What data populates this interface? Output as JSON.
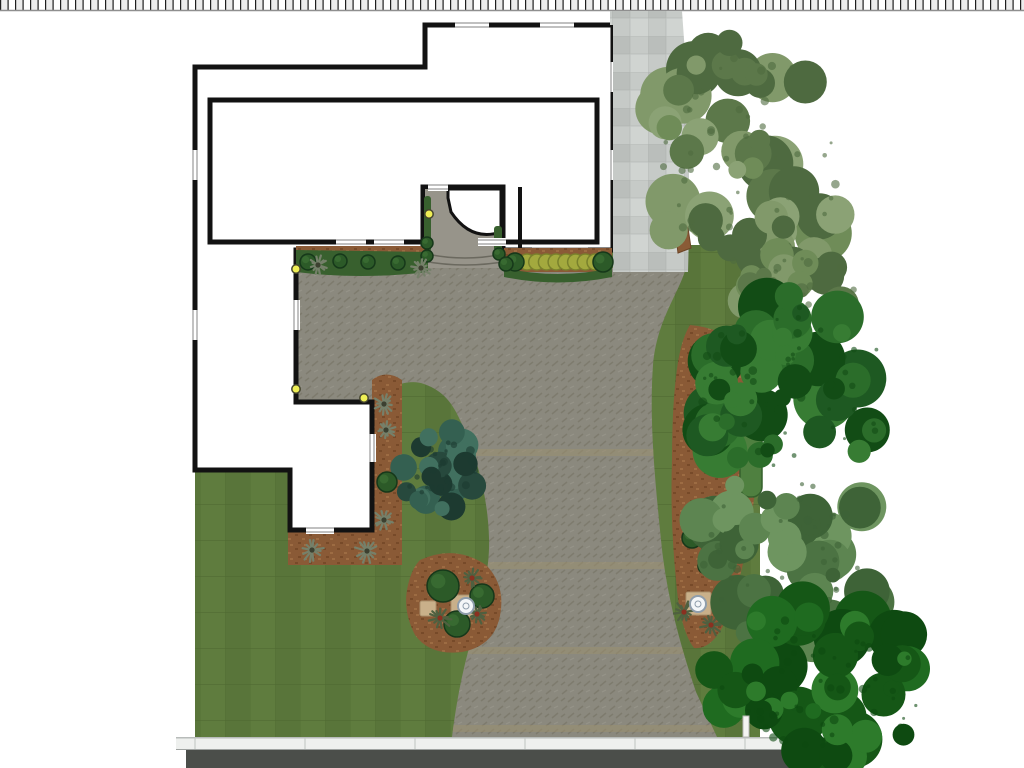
{
  "scene": {
    "type": "landscape-site-plan",
    "canvas": {
      "width": 1024,
      "height": 768
    },
    "plan_elements": [
      "scale-strip",
      "house-footprint",
      "front-entry-walkway",
      "paver-driveway",
      "paver-patio",
      "stone-side-path",
      "lawn",
      "foundation-planting-bed",
      "boxwood-hedge-row",
      "side-mulch-bed",
      "island-planting-bed",
      "east-mulch-bed",
      "juniper-shrub",
      "street",
      "sidewalk",
      "mailbox-post",
      "landscape-lights",
      "birdbaths",
      "street-trees"
    ],
    "counts": {
      "landscape_lights": 4,
      "birdbaths": 2,
      "hedge_shrubs": 8,
      "trees": 5
    },
    "colors": {
      "wall": "#121212",
      "house_fill": "#ffffff",
      "lawn": "#59753a",
      "lawn_stripe": "#5f7c3e",
      "lawn_line": "#4e6831",
      "paver": "#8b897e",
      "paver_motif": "#797768",
      "paver_band": "#9a9070",
      "walkway": "#97948a",
      "stone": "#c6cac7",
      "stone_dark": "#b7bcb9",
      "stone_light": "#d0d4d1",
      "mulch": "#8a5a36",
      "mulch_dark": "#774a29",
      "mulch_light": "#9d6c43",
      "bed_green": "#38602e",
      "hedge": "#a3a93e",
      "hedge_stroke": "#79812c",
      "bright_hedge": "#4f8040",
      "shrub": "#2c5a28",
      "shrub_stroke": "#16381a",
      "street": "#4b4e4a",
      "sidewalk": "#eef0ee",
      "sidewalk_line": "#c6cac8",
      "light": "#efef55",
      "light_ring": "#45452f",
      "birdbath": "#f4f6f8",
      "birdbath_ring": "#8f9dab",
      "trunk": "#8a5b36",
      "yucca_gray": "#75806a",
      "yucca_red": "#8a3020",
      "post": "#f4f4f2",
      "ruler_tick": "#1e1e1e",
      "ruler_cell": "#ececec",
      "ruler_edge": "#8f8f8f"
    },
    "ruler": {
      "tick_spacing": 7.5,
      "height": 10
    },
    "paver_bands": [
      449,
      562,
      647,
      725
    ],
    "sidewalk_joints": [
      195,
      305,
      415,
      525,
      635,
      745
    ],
    "lights": [
      {
        "x": 296,
        "y": 269
      },
      {
        "x": 429,
        "y": 214
      },
      {
        "x": 296,
        "y": 389
      },
      {
        "x": 364,
        "y": 398
      }
    ],
    "birdbaths": [
      {
        "x": 466,
        "y": 606
      },
      {
        "x": 698,
        "y": 604
      }
    ],
    "pads": [
      {
        "x": 420,
        "y": 601,
        "w": 16,
        "h": 15
      },
      {
        "x": 451,
        "y": 595,
        "w": 27,
        "h": 22
      },
      {
        "x": 686,
        "y": 592,
        "w": 25,
        "h": 23
      }
    ],
    "hedge_row": {
      "x_start": 527,
      "x_end": 595,
      "count": 8,
      "y": 262,
      "r": 8
    },
    "shrubs": [
      {
        "x": 515,
        "y": 262,
        "r": 9
      },
      {
        "x": 603,
        "y": 262,
        "r": 10
      },
      {
        "x": 308,
        "y": 262,
        "r": 8
      },
      {
        "x": 340,
        "y": 261,
        "r": 7
      },
      {
        "x": 368,
        "y": 262,
        "r": 7
      },
      {
        "x": 398,
        "y": 263,
        "r": 7
      },
      {
        "x": 427,
        "y": 243,
        "r": 6
      },
      {
        "x": 427,
        "y": 256,
        "r": 6
      },
      {
        "x": 499,
        "y": 254,
        "r": 6
      },
      {
        "x": 506,
        "y": 264,
        "r": 7
      },
      {
        "x": 387,
        "y": 482,
        "r": 10
      },
      {
        "x": 443,
        "y": 586,
        "r": 16
      },
      {
        "x": 482,
        "y": 596,
        "r": 12
      },
      {
        "x": 457,
        "y": 624,
        "r": 13
      },
      {
        "x": 692,
        "y": 538,
        "r": 10
      },
      {
        "x": 706,
        "y": 566,
        "r": 8
      }
    ],
    "spiky_plants": [
      {
        "x": 318,
        "y": 265,
        "r": 9,
        "red": false
      },
      {
        "x": 421,
        "y": 268,
        "r": 9,
        "red": false
      },
      {
        "x": 384,
        "y": 404,
        "r": 10,
        "red": false
      },
      {
        "x": 386,
        "y": 430,
        "r": 9,
        "red": false
      },
      {
        "x": 384,
        "y": 520,
        "r": 10,
        "red": false
      },
      {
        "x": 312,
        "y": 550,
        "r": 11,
        "red": false
      },
      {
        "x": 367,
        "y": 551,
        "r": 11,
        "red": false
      },
      {
        "x": 730,
        "y": 462,
        "r": 10,
        "red": false
      },
      {
        "x": 440,
        "y": 618,
        "r": 11,
        "red": true
      },
      {
        "x": 477,
        "y": 614,
        "r": 10,
        "red": true
      },
      {
        "x": 472,
        "y": 578,
        "r": 9,
        "red": true
      },
      {
        "x": 684,
        "y": 612,
        "r": 10,
        "red": true
      },
      {
        "x": 711,
        "y": 625,
        "r": 10,
        "red": true
      }
    ],
    "windows": [
      {
        "x": 455,
        "y": 21,
        "w": 34,
        "h": 8,
        "o": "h"
      },
      {
        "x": 540,
        "y": 21,
        "w": 34,
        "h": 8,
        "o": "h"
      },
      {
        "x": 609,
        "y": 62,
        "w": 8,
        "h": 30,
        "o": "v"
      },
      {
        "x": 609,
        "y": 150,
        "w": 8,
        "h": 30,
        "o": "v"
      },
      {
        "x": 336,
        "y": 238,
        "w": 30,
        "h": 8,
        "o": "h"
      },
      {
        "x": 374,
        "y": 238,
        "w": 30,
        "h": 8,
        "o": "h"
      },
      {
        "x": 478,
        "y": 238,
        "w": 28,
        "h": 8,
        "o": "h"
      },
      {
        "x": 532,
        "y": 246,
        "w": 56,
        "h": 8,
        "o": "h"
      },
      {
        "x": 191,
        "y": 150,
        "w": 8,
        "h": 30,
        "o": "v"
      },
      {
        "x": 191,
        "y": 310,
        "w": 8,
        "h": 30,
        "o": "v"
      },
      {
        "x": 292,
        "y": 300,
        "w": 8,
        "h": 30,
        "o": "v"
      },
      {
        "x": 368,
        "y": 434,
        "w": 8,
        "h": 28,
        "o": "v"
      },
      {
        "x": 306,
        "y": 526,
        "w": 28,
        "h": 8,
        "o": "h"
      },
      {
        "x": 428,
        "y": 183,
        "w": 20,
        "h": 8,
        "o": "h"
      }
    ],
    "trees": [
      {
        "name": "tree-upper-right",
        "cx": 750,
        "cy": 162,
        "rx": 100,
        "ry": 122,
        "n": 50,
        "seed": 7,
        "palette": [
          "#6f8c58",
          "#5c784a",
          "#81996a",
          "#8ba275",
          "#4e6a40"
        ]
      },
      {
        "name": "tree-right-lobe",
        "cx": 802,
        "cy": 292,
        "rx": 58,
        "ry": 42,
        "n": 18,
        "seed": 3,
        "palette": [
          "#6f8c58",
          "#5c784a",
          "#81996a",
          "#4e6a40"
        ]
      },
      {
        "name": "tree-mid-right-dark",
        "cx": 795,
        "cy": 388,
        "rx": 108,
        "ry": 93,
        "n": 48,
        "seed": 11,
        "palette": [
          "#2b6d2a",
          "#1e5922",
          "#377c33",
          "#124c15"
        ]
      },
      {
        "name": "tree-lower-right-sage",
        "cx": 786,
        "cy": 558,
        "rx": 98,
        "ry": 86,
        "n": 42,
        "seed": 23,
        "palette": [
          "#5d8551",
          "#4c7343",
          "#6e9560",
          "#3e6337"
        ]
      },
      {
        "name": "tree-bottom-dark",
        "cx": 820,
        "cy": 686,
        "rx": 112,
        "ry": 80,
        "n": 46,
        "seed": 31,
        "palette": [
          "#1f6b20",
          "#155716",
          "#2d7b2b",
          "#0e4a11"
        ]
      }
    ],
    "shrub_clusters": [
      {
        "name": "juniper-shrub",
        "cx": 443,
        "cy": 470,
        "rx": 44,
        "ry": 40,
        "n": 26,
        "seed": 5,
        "palette": [
          "#346051",
          "#27493d",
          "#41705f",
          "#1d3a30"
        ]
      }
    ]
  }
}
